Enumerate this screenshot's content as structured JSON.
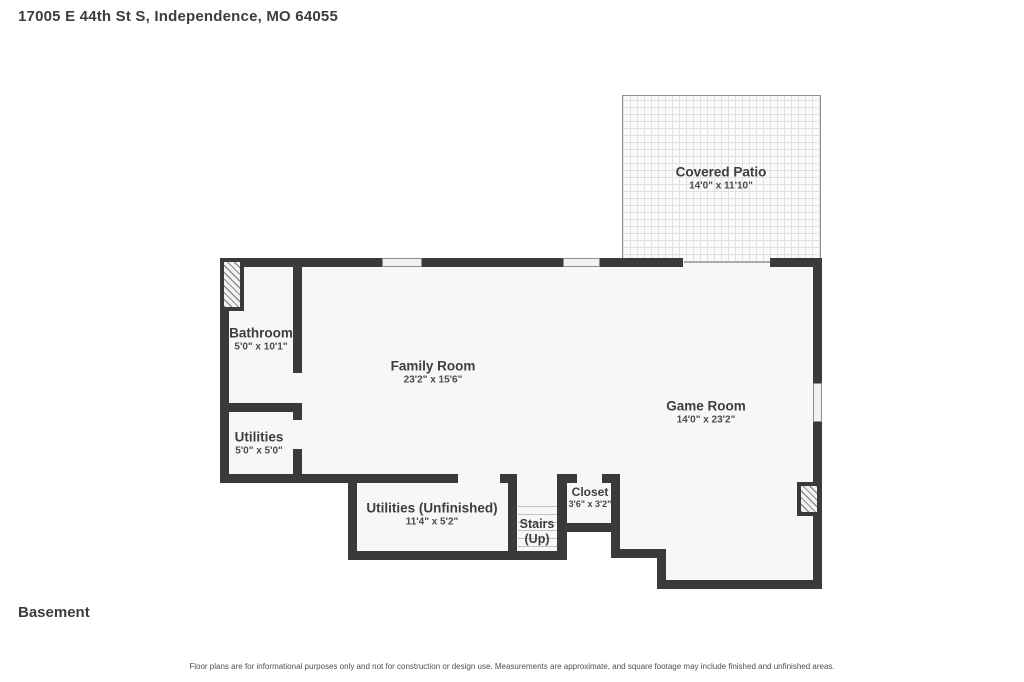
{
  "header": {
    "address": "17005 E 44th St S, Independence, MO 64055"
  },
  "floor_label": "Basement",
  "disclaimer": "Floor plans are for informational purposes only and not for construction or design use. Measurements are approximate, and square footage may include finished and unfinished areas.",
  "rooms": {
    "covered_patio": {
      "name": "Covered Patio",
      "dims": "14'0\" x 11'10\""
    },
    "bathroom": {
      "name": "Bathroom",
      "dims": "5'0\" x 10'1\""
    },
    "family_room": {
      "name": "Family Room",
      "dims": "23'2\" x 15'6\""
    },
    "game_room": {
      "name": "Game Room",
      "dims": "14'0\" x 23'2\""
    },
    "utilities": {
      "name": "Utilities",
      "dims": "5'0\" x 5'0\""
    },
    "utilities_unfinished": {
      "name": "Utilities (Unfinished)",
      "dims": "11'4\" x 5'2\""
    },
    "stairs": {
      "name": "Stairs",
      "direction": "(Up)"
    },
    "closet": {
      "name": "Closet",
      "dims": "3'6\" x 3'2\""
    }
  },
  "colors": {
    "wall": "#3a3a3a",
    "floor": "#f7f7f7",
    "text": "#3e3e3e",
    "patio_border": "#8f8f8f"
  }
}
